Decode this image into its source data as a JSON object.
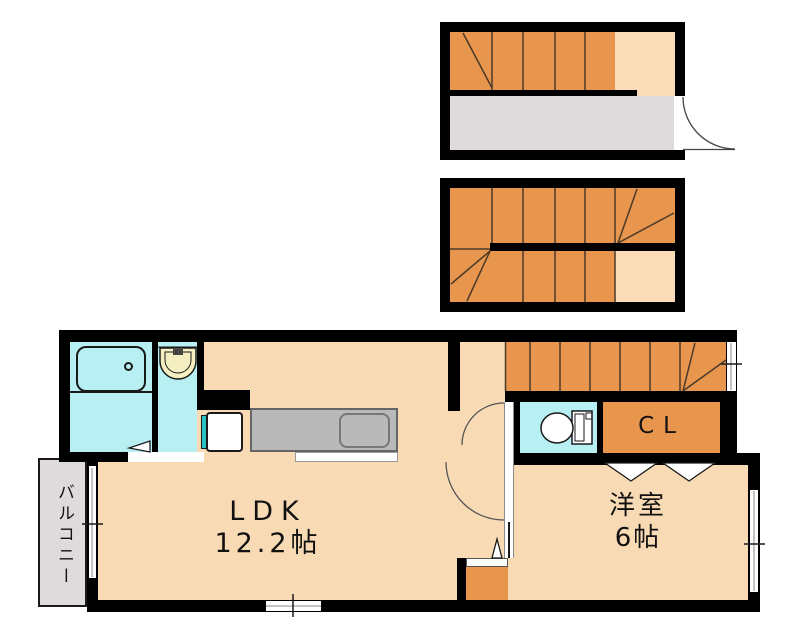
{
  "floorplan": {
    "rooms": {
      "ldk": {
        "name": "LDK",
        "size": "12.2帖"
      },
      "western": {
        "name": "洋室",
        "size": "6帖"
      },
      "closet": {
        "label": "CL"
      },
      "balcony": {
        "label": "バルコニー"
      }
    },
    "colors": {
      "wall": "#000000",
      "floor": "#f8dbb4",
      "stair_step": "#e8954e",
      "stair_landing": "#fadcb8",
      "wet_area": "#b8eff2",
      "gray_area": "#dfdadb",
      "kitchen_counter": "#b9b9b9",
      "appliance_accent": "#2ac0c4",
      "washbasin": "#f4eec0"
    }
  }
}
